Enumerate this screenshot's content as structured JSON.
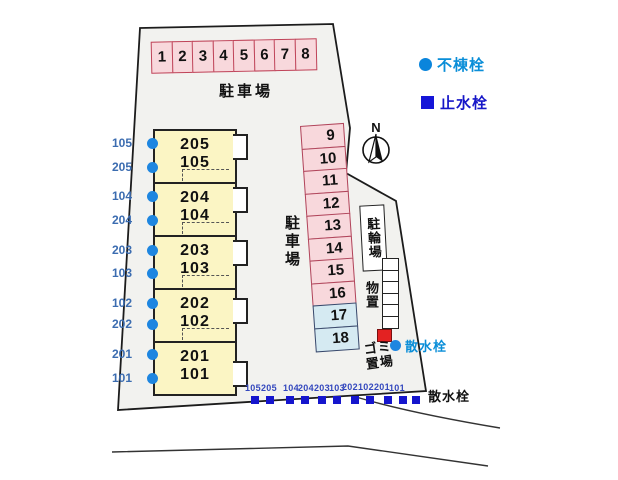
{
  "site": {
    "parking_top": {
      "label": "駐車場",
      "spaces": [
        "1",
        "2",
        "3",
        "4",
        "5",
        "6",
        "7",
        "8"
      ]
    },
    "parking_side": {
      "label": "駐車場",
      "spaces": [
        "9",
        "10",
        "11",
        "12",
        "13",
        "14",
        "15",
        "16",
        "17",
        "18"
      ]
    },
    "building_units": [
      {
        "upper": "205",
        "lower": "105"
      },
      {
        "upper": "204",
        "lower": "104"
      },
      {
        "upper": "203",
        "lower": "103"
      },
      {
        "upper": "202",
        "lower": "102"
      },
      {
        "upper": "201",
        "lower": "101"
      }
    ],
    "left_markers": [
      "105",
      "205",
      "104",
      "204",
      "203",
      "103",
      "102",
      "202",
      "201",
      "101"
    ],
    "bottom_markers": [
      "105",
      "205",
      "104",
      "204",
      "203",
      "103",
      "202",
      "102",
      "201",
      "101"
    ],
    "bicycle_parking_label": "駐輪場",
    "storage_label": "物置",
    "garbage_line1": "ゴミ",
    "garbage_line2": "置場",
    "sprinkler_mid_label": "散水栓",
    "sprinkler_bottom_label": "散水栓",
    "compass_label": "N"
  },
  "legend": {
    "items": [
      {
        "symbol": "circle",
        "label": "不棟栓",
        "color": "#0a85dc"
      },
      {
        "symbol": "square",
        "label": "止水栓",
        "color": "#1515d8"
      }
    ]
  },
  "colors": {
    "hydrant_dot": "#1e86e0",
    "valve_square": "#1515cd",
    "pink_space_fill": "#f8d8dc",
    "pink_space_border": "#bf4459",
    "blue_space_fill": "#d5eaf2",
    "unit_fill": "#fbf5c4",
    "site_fill": "#f2f2ef",
    "garbage_marker": "#e32222",
    "left_label_text": "#3b6cb0",
    "bottom_label_text": "#3448be"
  }
}
